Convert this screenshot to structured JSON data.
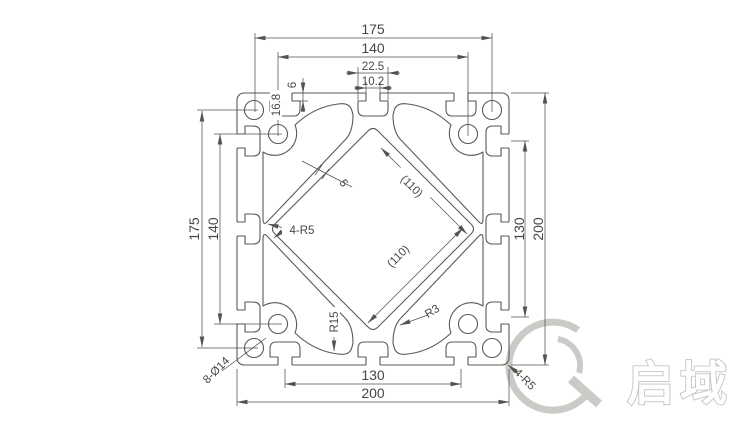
{
  "drawing": {
    "dims": {
      "top_overall": "175",
      "top_inner": "140",
      "slot_cavity": "22.5",
      "slot_opening": "10.2",
      "slot_depth": "16.8",
      "slot_lip": "6",
      "left_overall": "175",
      "left_inner": "140",
      "right_slots": "130",
      "right_overall": "200",
      "bottom_slots": "130",
      "bottom_overall": "200",
      "cavity_side_a": "(110)",
      "cavity_side_b": "(110)",
      "wall_thickness": "5"
    },
    "callouts": {
      "center_radius": "4-R5",
      "fillet_radius": "R15",
      "corner_fillet": "R3",
      "holes": "8-Ø14",
      "outer_corner_radius": "4-R5"
    },
    "brand": "启域"
  }
}
